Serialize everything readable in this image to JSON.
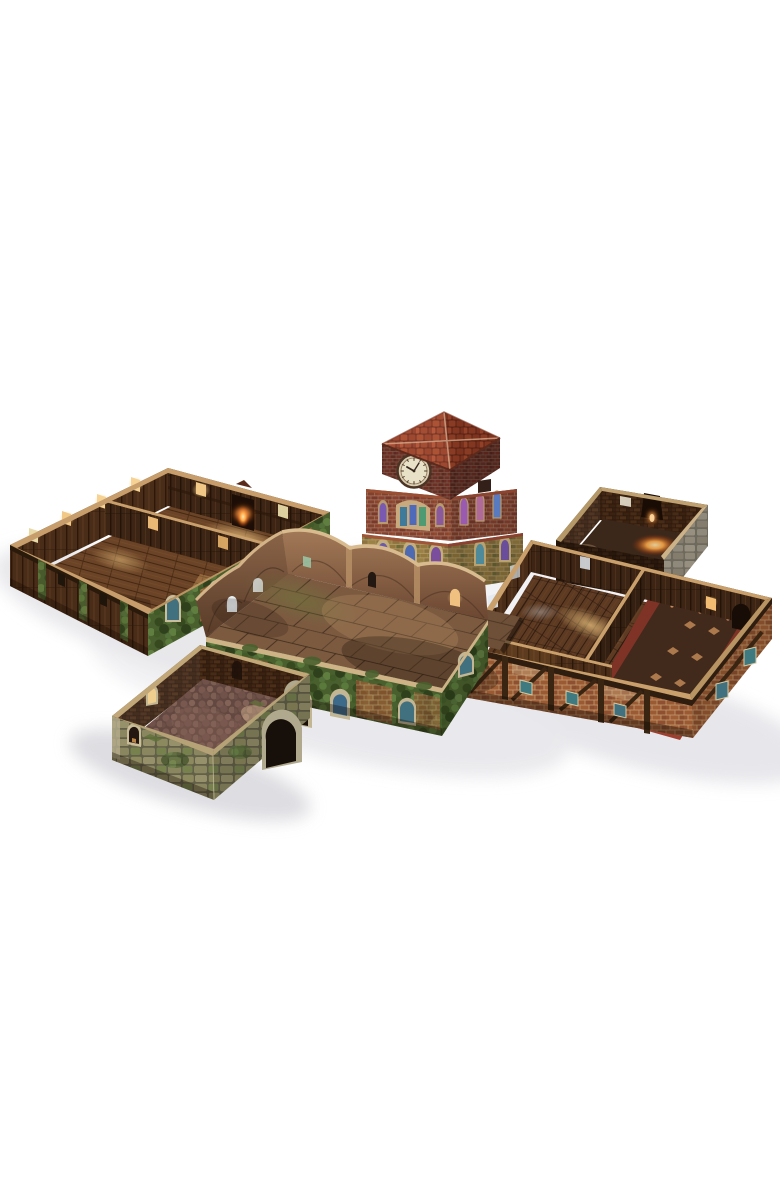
{
  "photo": {
    "subject": "Modular fantasy-town tabletop terrain set of papercraft building trays on a white studio background",
    "background_color": "#ffffff"
  },
  "components": [
    {
      "name": "tavern-hall-tray",
      "description": "Large two-room tray, dark wood-plank walls, glowing amber windows, stone fireplace, timber-and-ivy exterior"
    },
    {
      "name": "clock-tower-building",
      "description": "Three-tier brick tower with red tiled hip roof, white clock face and stained-glass windows"
    },
    {
      "name": "furnace-room-tray",
      "description": "Small dark-brick room with glowing furnace and grey stone outer corner"
    },
    {
      "name": "timber-tavern-tray",
      "description": "Large tray with Tudor timber-framed brick exterior, plank rooms and an ornate rug"
    },
    {
      "name": "stone-courtyard-platform",
      "description": "Raised flagstone courtyard with arched parapet walls and ivy-covered exterior"
    },
    {
      "name": "garden-cell-tray",
      "description": "Small mossy stone room with arched doorway and rough mauve cobble floor"
    }
  ],
  "palette": {
    "background": "#ffffff",
    "shadow": "#e4e4e8",
    "shadow_deep": "#d8d8dd",
    "rim_tan": "#c9a06b",
    "coping_tan": "#cdb386",
    "rim_moss": "#c2a878",
    "flagstone_base": "#7c5a40",
    "cobble_base": "#70524a",
    "furnace_floor": "#3b281a",
    "rug_border": "#7e3326",
    "rug_field": "#41291c",
    "rug_fringe": "#9e4030",
    "glass_teal": "#3f7a80",
    "glass_blue": "#3e6a8a",
    "glow_amber": "#f2bc72",
    "window_warm": "#f6d394",
    "clock_face": "#e9e0c8",
    "ivy_green": "#49602e",
    "roof_tile": "#a8492b",
    "brick_red": "#8a4130",
    "stone_moss": "#8d895f",
    "plank_dark": "#3c2515",
    "wood_floor": "#6b4326"
  }
}
